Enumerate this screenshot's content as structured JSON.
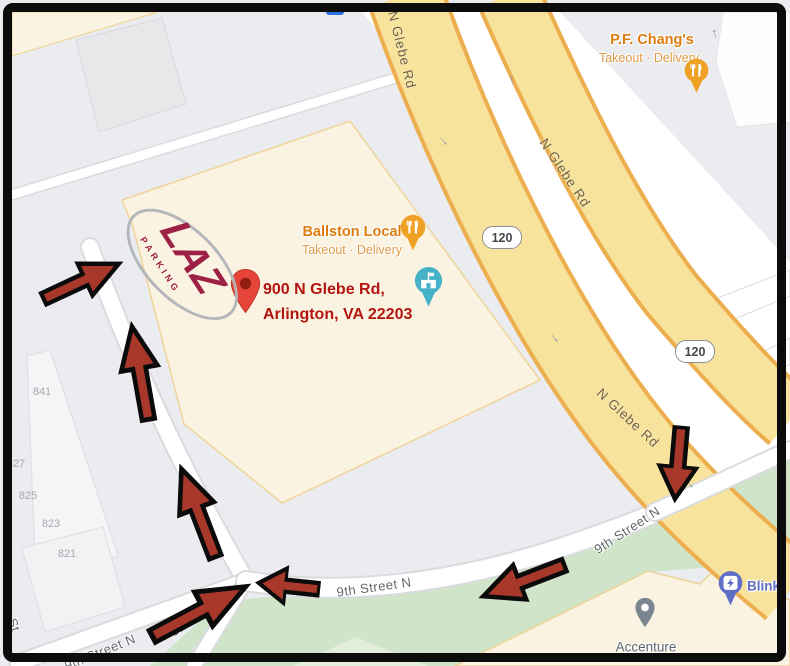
{
  "destination": {
    "address_line1": "900 N Glebe Rd,",
    "address_line2": "Arlington, VA 22203"
  },
  "pois": {
    "pf_changs": {
      "name": "P.F. Chang's",
      "subtitle": "Takeout · Delivery"
    },
    "ballston_local": {
      "name": "Ballston Local",
      "subtitle": "Takeout · Delivery"
    },
    "accenture": {
      "name": "Accenture"
    },
    "blink": {
      "name": "Blink"
    }
  },
  "roads": {
    "n_glebe": "N Glebe Rd",
    "ninth_street": "9th Street N",
    "partial_street": "St",
    "route_shield": "120"
  },
  "building_numbers": [
    "841",
    "827",
    "825",
    "823",
    "821"
  ],
  "parking_logo": {
    "brand": "LAZ",
    "sub": "PARKING"
  },
  "icons": {
    "route_arrow": "thick red arrow with black outline",
    "destination_pin": "red teardrop map pin",
    "restaurant_pin": "orange circle pin with fork and knife",
    "school_pin": "teal circle pin with building and flag",
    "place_pin": "gray teardrop pin",
    "ev_pin": "indigo circle pin with charger",
    "oneway_arrow": "small gray one-way arrow"
  },
  "colors": {
    "arrow_red": "#a8382a",
    "address_red": "#b3140f",
    "laz_maroon": "#9d2144",
    "poi_orange": "#df7c10",
    "road_yellow": "#f8e39c",
    "road_yellow_edge": "#ecae4e",
    "park_green": "#cfe4c8",
    "block_cream": "#faf3e1",
    "blink_indigo": "#5f6ec7",
    "frame_black": "#0c0c0c"
  }
}
